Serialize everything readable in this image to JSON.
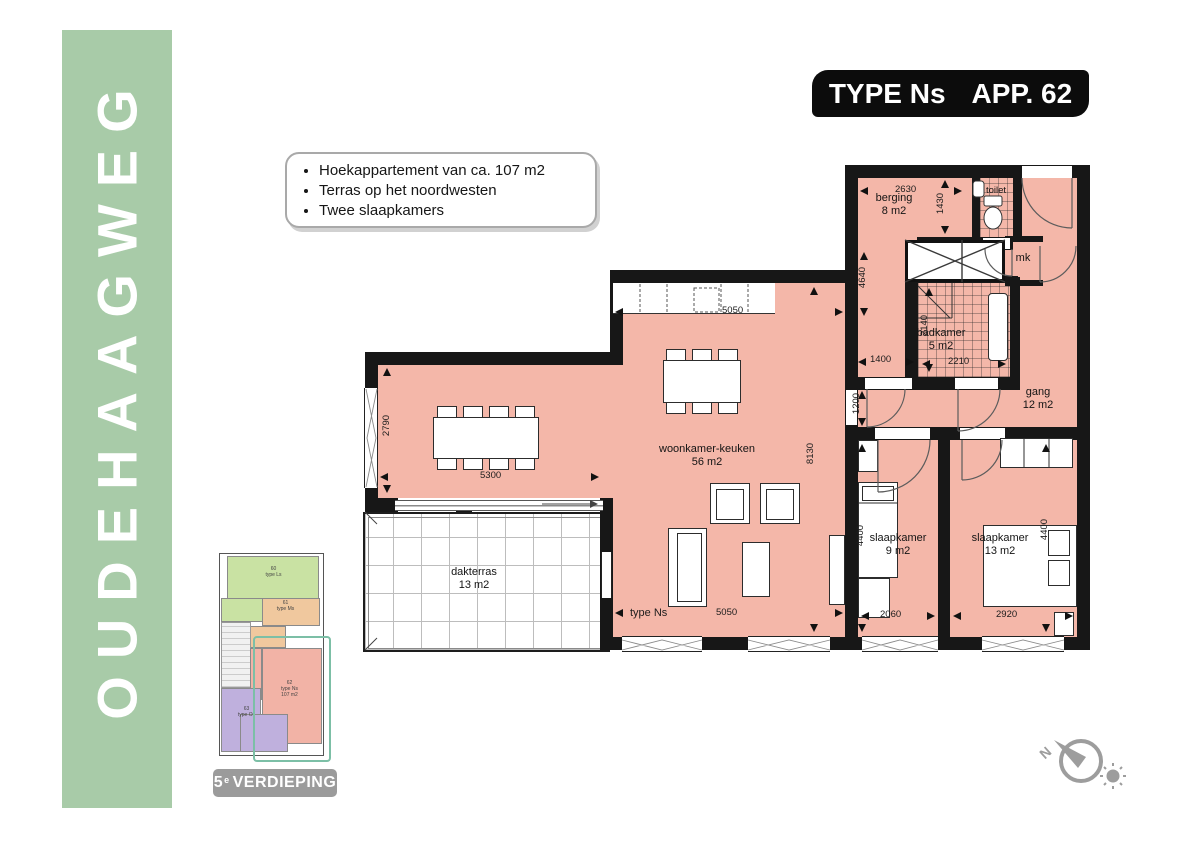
{
  "banner": {
    "text": "OUDEHAAGWEG"
  },
  "title": {
    "type_label": "TYPE Ns",
    "app_label": "APP. 62"
  },
  "features": [
    "Hoekappartement van ca. 107 m2",
    "Terras op het noordwesten",
    "Twee slaapkamers"
  ],
  "plan": {
    "rooms": {
      "berging": {
        "name": "berging",
        "area": "8 m2"
      },
      "toilet": {
        "name": "toilet"
      },
      "mk": {
        "name": "mk"
      },
      "badkamer": {
        "name": "badkamer",
        "area": "5 m2"
      },
      "gang": {
        "name": "gang",
        "area": "12 m2"
      },
      "woonkamer": {
        "name": "woonkamer-keuken",
        "area": "56 m2"
      },
      "slaapkamer1": {
        "name": "slaapkamer",
        "area": "9 m2"
      },
      "slaapkamer2": {
        "name": "slaapkamer",
        "area": "13 m2"
      },
      "dakterras": {
        "name": "dakterras",
        "area": "13 m2"
      }
    },
    "type_marker": "type Ns",
    "dims": {
      "berging_w": "2630",
      "toilet_h": "1430",
      "entry_h": "4640",
      "badkamer_h": "2140",
      "badkamer_w": "2210",
      "hall_w": "1400",
      "hall_h": "1200",
      "woonkamer_h": "8130",
      "kitchen_w": "5050",
      "left_h": "2790",
      "left_w": "5300",
      "bottom_w": "5050",
      "bed1_w": "2060",
      "bed1_h": "4400",
      "bed2_w": "2920",
      "bed2_h": "4400"
    }
  },
  "mini": {
    "units": [
      {
        "number": "60",
        "type": "type Ls"
      },
      {
        "number": "61",
        "type": "type Ms"
      },
      {
        "number": "62",
        "type": "type Ns",
        "area": "107 m2"
      },
      {
        "number": "63",
        "type": "type Os"
      }
    ],
    "floor_num": "5",
    "floor_sup": "e",
    "floor_name": "VERDIEPING"
  },
  "compass": {
    "north": "N"
  },
  "colors": {
    "floor": "#f4b7a9",
    "banner": "#a8cba8",
    "accent_teal": "#7cbfa6",
    "label_gray": "#9b9b9b",
    "wall": "#171717"
  }
}
